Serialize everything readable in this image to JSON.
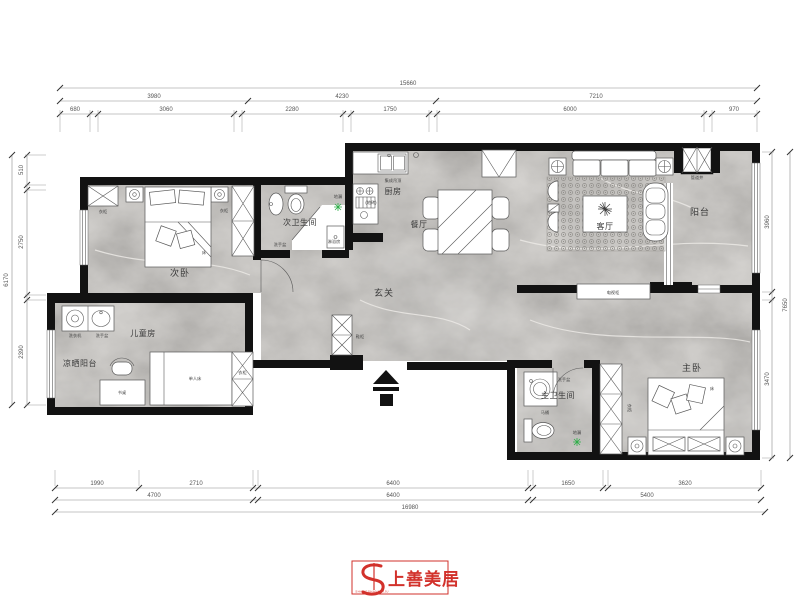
{
  "rooms": {
    "secondary_bedroom": "次卧",
    "secondary_bathroom": "次卫生间",
    "kitchen": "厨房",
    "dining": "餐厅",
    "living": "客厅",
    "balcony": "阳台",
    "foyer": "玄关",
    "kids_room": "儿童房",
    "drying_balcony": "凉晒阳台",
    "master_bathroom": "主卫生间",
    "master_bedroom": "主卧"
  },
  "fixtures": {
    "wardrobe": "衣柜",
    "shoe_cabinet": "鞋柜",
    "bed": "床",
    "single_bed": "单人床",
    "desk": "书桌",
    "washing_machine": "洗衣机",
    "wash_basin": "洗手盆",
    "shower_room": "淋浴房",
    "floor_drain": "地漏",
    "toilet": "马桶",
    "tv_cabinet": "电视柜",
    "duct_shaft": "管道井",
    "ceiling_note": "集成吊顶",
    "floor_tile_note": "(地砖)"
  },
  "dims": {
    "top": {
      "overall": "15660",
      "row2": [
        "3980",
        "4230",
        "7210"
      ],
      "row3": [
        "680",
        "3060",
        "2280",
        "1750",
        "6000",
        "970"
      ]
    },
    "bottom": {
      "row1": [
        "1990",
        "2710",
        "6400",
        "1650",
        "3620"
      ],
      "row2": [
        "4700",
        "6400",
        "5400"
      ],
      "overall": "16980"
    },
    "left": {
      "segments": [
        "510",
        "2750",
        "2390"
      ],
      "overall": "6170"
    },
    "right": {
      "segments": [
        "3960",
        "3470"
      ],
      "overall": "7650"
    }
  },
  "logo": {
    "name": "上善美居",
    "subtext": "SHANGSHANMEIJU"
  },
  "colors": {
    "wall": "#121212",
    "floor": "#c8c5c0",
    "logo_red": "#d2312b",
    "drain_green": "#2fae49"
  }
}
